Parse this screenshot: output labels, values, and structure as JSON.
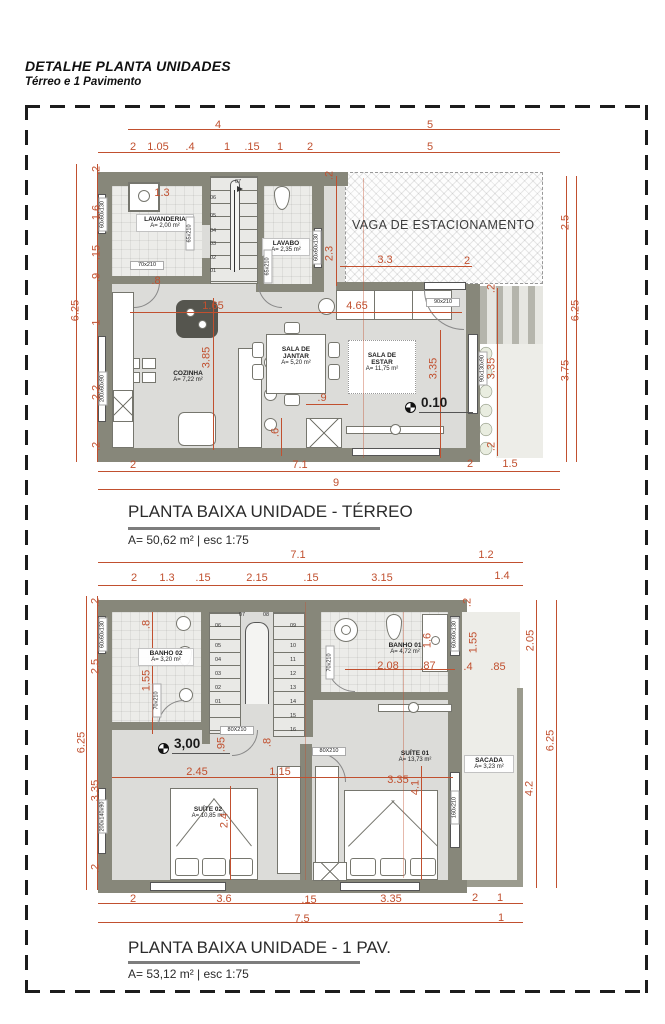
{
  "header": {
    "title": "DETALHE PLANTA UNIDADES",
    "subtitle": "Térreo e 1 Pavimento"
  },
  "terreo": {
    "plan_title": "PLANTA BAIXA UNIDADE - TÉRREO",
    "plan_subtitle": "A= 50,62 m²  |  esc 1:75",
    "level": "0.10",
    "rooms": {
      "lavanderia_name": "LAVANDERIA",
      "lavanderia_area": "A= 2,00 m²",
      "lavabo_name": "LAVABO",
      "lavabo_area": "A= 2,35 m²",
      "cozinha_name": "COZINHA",
      "cozinha_area": "A= 7,22 m²",
      "sala_jantar_name": "SALA DE\nJANTAR",
      "sala_jantar_area": "A= 5,20 m²",
      "sala_estar_name": "SALA DE\nESTAR",
      "sala_estar_area": "A= 11,75 m²",
      "vaga_name": "VAGA DE ESTACIONAMENTO"
    },
    "tags": {
      "janela_lavanderia": "60x60x130",
      "porta_lavanderia": "65x210",
      "porta_cozinha": "70x210",
      "janela_lavabo": "60x60x130",
      "porta_lavabo": "65x210",
      "porta_sala": "90x210",
      "janela_cozinha": "200x60x90",
      "jardineira": "90x130x90"
    },
    "stairs": [
      "01",
      "02",
      "03",
      "04",
      "05",
      "06",
      "07"
    ],
    "dims": [
      "4",
      "5",
      "2",
      "1.05",
      ".4",
      "1",
      ".15",
      "1",
      "2",
      "5",
      "6.25",
      ".2",
      "1.6",
      ".15",
      ".9",
      "1",
      "2.2",
      ".2",
      "2.5",
      "6.25",
      "3.75",
      "1.3",
      ".8",
      "1.65",
      "3.85",
      "4.65",
      "2.3",
      ".2",
      "3.3",
      "2",
      "3.35",
      "3.35",
      ".2",
      ".2",
      ".9",
      ".6",
      "7.1",
      "2",
      "9",
      "2",
      "1.5"
    ]
  },
  "pav1": {
    "plan_title": "PLANTA BAIXA UNIDADE - 1 PAV.",
    "plan_subtitle": "A= 53,12 m²  |  esc 1:75",
    "level": "3,00",
    "rooms": {
      "banho02_name": "BANHO 02",
      "banho02_area": "A= 3,20 m²",
      "banho01_name": "BANHO 01",
      "banho01_area": "A= 4,72 m²",
      "suite02_name": "SUÍTE 02",
      "suite02_area": "A= 10,85 m²",
      "suite01_name": "SUÍTE 01",
      "suite01_area": "A= 13,73 m²",
      "sacada_name": "SACADA",
      "sacada_area": "A= 3,23 m²"
    },
    "tags": {
      "janela_banho02": "60x60x130",
      "porta_banho02": "70x210",
      "porta_banho01": "70x210",
      "janela_banho01": "60x60x130",
      "porta_suite02": "80X210",
      "porta_suite01": "80X210",
      "janela_sacada": "160x210",
      "janela_suite02": "200x140x90"
    },
    "stairs": [
      "01",
      "02",
      "03",
      "04",
      "05",
      "06",
      "07",
      "08",
      "09",
      "10",
      "11",
      "12",
      "13",
      "14",
      "15",
      "16"
    ],
    "dims": [
      "7.1",
      "1.2",
      "2",
      "1.3",
      ".15",
      "2.15",
      ".15",
      "3.15",
      "1.4",
      "6.25",
      ".2",
      "2.5",
      "3.35",
      ".2",
      ".8",
      "1.55",
      "2.08",
      ".87",
      "1.6",
      ".2",
      "1.55",
      ".4",
      ".85",
      "2.05",
      ".95",
      ".8",
      "2.45",
      "1.15",
      "3.35",
      "2.4",
      "4.1",
      "4.2",
      "6.25",
      "2",
      "3.6",
      ".15",
      "3.35",
      "7.5",
      "2",
      "1",
      "1"
    ]
  }
}
